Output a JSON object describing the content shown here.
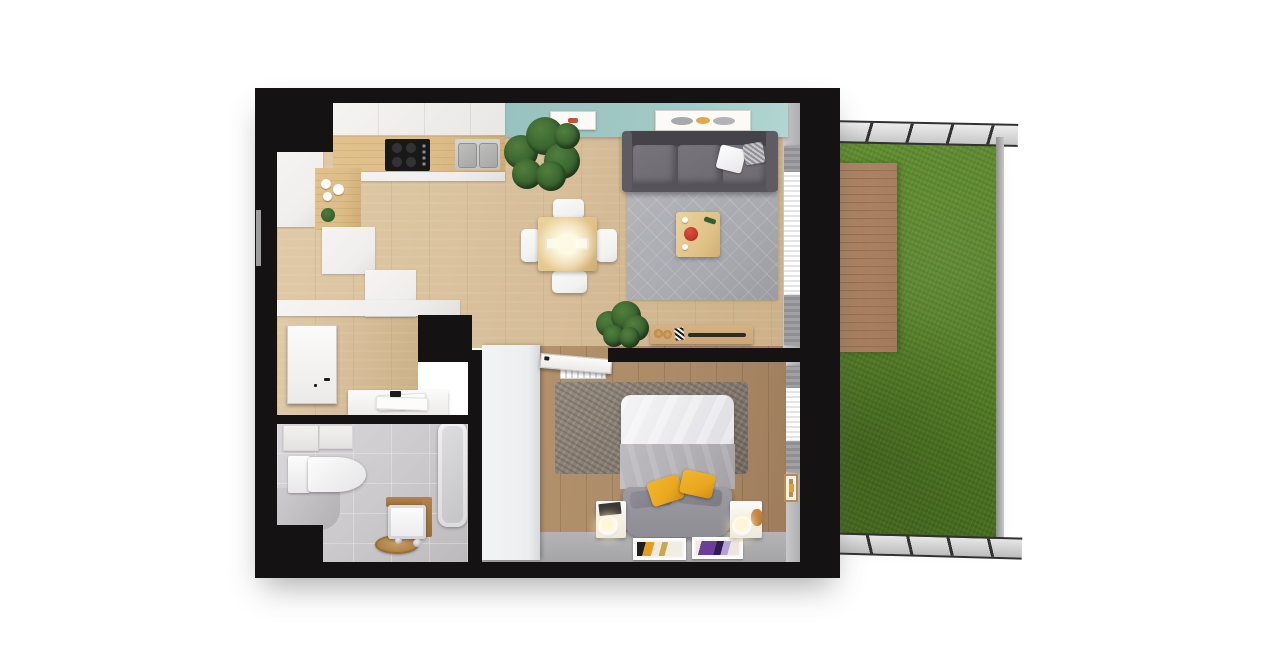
{
  "scene": {
    "type": "3d-floor-plan-top-view",
    "description": "Top-down 3D architectural render of a one-bedroom apartment with open kitchen/living room, hallway, bathroom, bedroom and a fenced garden with wooden deck on the right",
    "rooms": [
      {
        "name": "kitchen-living-room",
        "objects": [
          "kitchen-cabinets",
          "cooktop",
          "double-sink",
          "teal-accent-wall",
          "two-wall-frames",
          "dining-table",
          "four-white-chairs",
          "pendant-light-glow",
          "gray-sofa",
          "area-rug",
          "coffee-table-with-red-bowl",
          "tv-sideboard",
          "two-potted-plants",
          "window-curtains"
        ]
      },
      {
        "name": "hallway",
        "objects": [
          "entry-door",
          "console-table-with-papers"
        ]
      },
      {
        "name": "bathroom",
        "objects": [
          "wall-hung-toilet",
          "bathtub",
          "washbasin-with-wood-panel",
          "round-wooden-mat",
          "gray-bench",
          "storage-shelf"
        ]
      },
      {
        "name": "bedroom",
        "objects": [
          "double-bed-white-duvet",
          "gray-blanket",
          "yellow-pillows",
          "upholstered-bed-end",
          "two-nightstands",
          "two-glass-sphere-lamps",
          "wardrobe",
          "shaggy-rug",
          "two-floor-art-prints",
          "radiator",
          "window-curtains",
          "leaning-wall-frame"
        ]
      },
      {
        "name": "garden",
        "objects": [
          "lawn",
          "wooden-deck",
          "perimeter-fence"
        ]
      }
    ]
  },
  "colors": {
    "wall": "#151213",
    "floor_wood": "#d6bd98",
    "floor_wood_dark": "#ab8a67",
    "gray_floor": "#a5a5a7",
    "teal": "#a2c9c5",
    "grass": "#649033",
    "grass_dark": "#527c25",
    "deck": "#b08767",
    "deck_line": "#956f4e",
    "fence": "#c7c7c7",
    "fence_dark": "#323032",
    "cabinet": "#efeeec",
    "counter_wood": "#dcbc87",
    "table_wood": "#e0c288",
    "chair": "#f1f1ef",
    "sofa": "#57555b",
    "sofa_cushion": "#6d6b71",
    "rug_living": "#a9aab0",
    "rug_bedroom": "#857b70",
    "duvet": "#ececef",
    "blanket": "#b2b0b4",
    "bed_frame": "#8f8d94",
    "pillow_yellow": "#e9a81f",
    "bath_tile": "#cbc9cb",
    "curtain_gray": "#8e8e93",
    "plant": "#39642f",
    "plant_dark": "#27481f",
    "wood_furniture": "#cda673",
    "red_accent": "#c2392e"
  }
}
